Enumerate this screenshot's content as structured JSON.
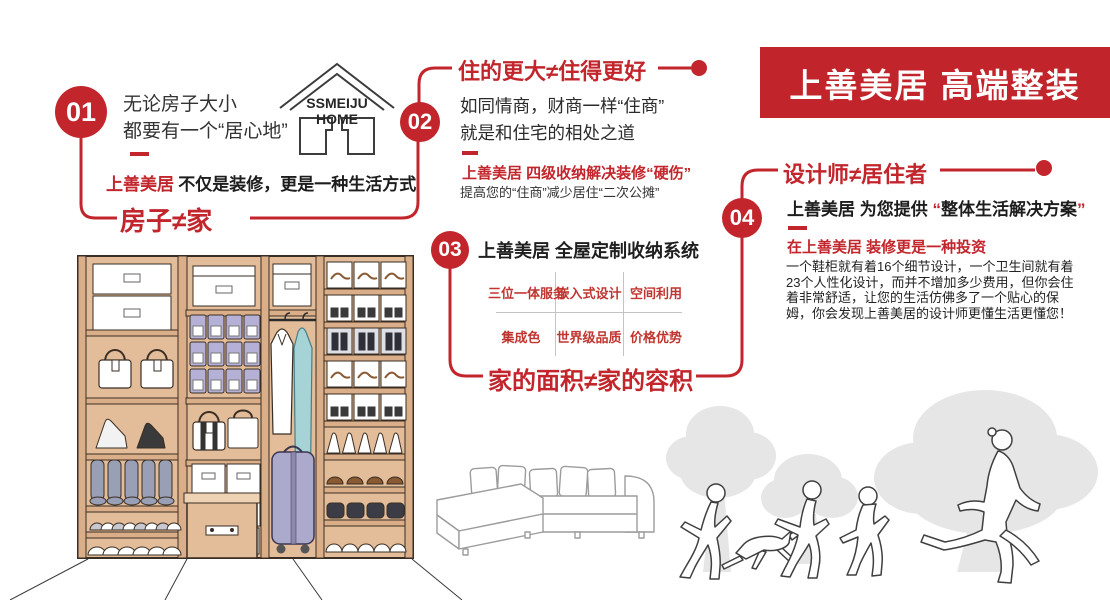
{
  "colors": {
    "accent": "#C2262C",
    "banner_bg": "#C2242B",
    "wardrobe_tan": "#E3BC99",
    "bin_lavender": "#B5B0D5",
    "suitcase_lavender": "#ACAACC",
    "garment_teal": "#A6D3D6",
    "tree_gray": "#E6E6E6"
  },
  "banner": {
    "title": "上善美居 高端整装"
  },
  "logo": {
    "line1": "SSMEIJU",
    "line2": "HOME"
  },
  "sections": {
    "s01": {
      "num": "01",
      "line1": "无论房子大小",
      "line2": "都要有一个“居心地”",
      "brand": "上善美居",
      "sub": "不仅是装修，更是一种生活方式",
      "slogan": "房子≠家"
    },
    "s02": {
      "num": "02",
      "header": "住的更大≠住得更好",
      "line1": "如同情商，财商一样“住商”",
      "line2": "就是和住宅的相处之道",
      "red_line": "上善美居 四级收纳解决装修“硬伤”",
      "black_line": "提高您的“住商”减少居住“二次公摊”"
    },
    "s03": {
      "num": "03",
      "title": "上善美居 全屋定制收纳系统",
      "table": [
        [
          "三位一体服务",
          "嵌入式设计",
          "空间利用"
        ],
        [
          "集成色",
          "世界级品质",
          "价格优势"
        ]
      ],
      "slogan": "家的面积≠家的容积"
    },
    "s04": {
      "num": "04",
      "header": "设计师≠居住者",
      "lead_pre": "上善美居 为您提供 ",
      "quote_open": "“",
      "lead_main": "整体生活解决方案",
      "quote_close": "”",
      "red_line": "在上善美居 装修更是一种投资",
      "paragraph": "一个鞋柜就有着16个细节设计，一个卫生间就有着23个人性化设计，而并不增加多少费用，但你会住着非常舒适，让您的生活仿佛多了一个贴心的保姆，你会发现上善美居的设计师更懂生活更懂您！"
    }
  }
}
